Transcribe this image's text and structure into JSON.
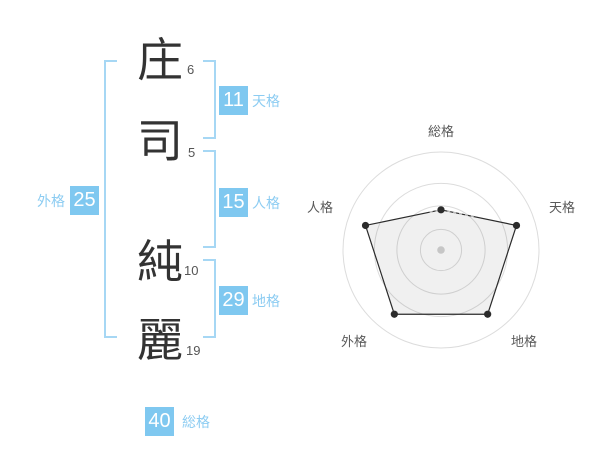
{
  "page": {
    "background": "#ffffff",
    "description_label": "name stroke-count fortune panel"
  },
  "name_analysis": {
    "characters": [
      {
        "char": "庄",
        "strokes": "6",
        "part": "surname"
      },
      {
        "char": "司",
        "strokes": "5",
        "part": "surname"
      },
      {
        "char": "純",
        "strokes": "10",
        "part": "given"
      },
      {
        "char": "麗",
        "strokes": "19",
        "part": "given"
      }
    ],
    "categories": [
      {
        "id": "tenkaku",
        "label": "天格",
        "value": "11"
      },
      {
        "id": "jinkaku",
        "label": "人格",
        "value": "15"
      },
      {
        "id": "chikaku",
        "label": "地格",
        "value": "29"
      },
      {
        "id": "gaikaku",
        "label": "外格",
        "value": "25"
      },
      {
        "id": "soukaku",
        "label": "総格",
        "value": "40"
      }
    ]
  },
  "colors": {
    "accent_blue": "#7fc8f0",
    "bracket_blue": "#a6d7f4",
    "label_blue": "#8cccf2",
    "box_value_text": "#ffffff",
    "kanji_text": "#333333",
    "stroke_count_text": "#555555",
    "chart_grid": "#dcdcdc",
    "chart_line": "#2b2b2b",
    "chart_fill": "rgba(0,0,0,0.06)",
    "chart_label": "#595959",
    "chart_center_dot": "#c6c6c6",
    "chart_dashed": "#bbbbbb"
  },
  "chart_data": {
    "type": "radar",
    "axes": [
      "総格",
      "天格",
      "地格",
      "外格",
      "人格"
    ],
    "series": [
      {
        "name": "fortune-score",
        "values": [
          41,
          81,
          81,
          81,
          81
        ]
      }
    ],
    "scale_max": 100,
    "ring_levels": [
      21,
      45,
      68,
      100
    ],
    "grid": "circular",
    "legend": "none",
    "dashed_accent_axis": 0
  }
}
